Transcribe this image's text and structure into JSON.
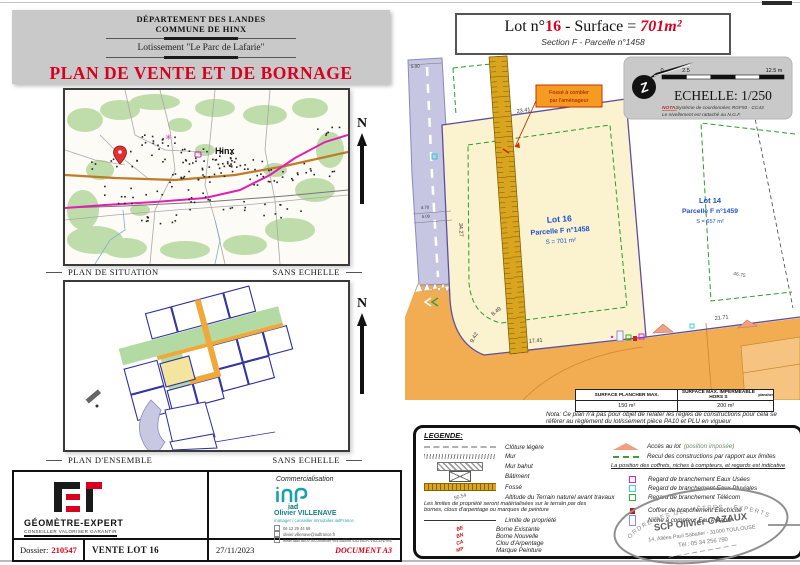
{
  "header": {
    "department": "DÉPARTEMENT DES LANDES",
    "commune": "COMMUNE DE HINX",
    "lotissement": "Lotissement \"Le Parc de Lafarie\"",
    "title": "PLAN DE VENTE ET DE BORNAGE"
  },
  "situation": {
    "town": "Hinx",
    "caption": "PLAN DE SITUATION",
    "scale_note": "SANS ECHELLE",
    "north": "N"
  },
  "ensemble": {
    "caption": "PLAN D'ENSEMBLE",
    "scale_note": "SANS ECHELLE",
    "north": "N"
  },
  "plan": {
    "title_prefix": "Lot n°",
    "lot_number": "16",
    "title_mid": " - Surface = ",
    "surface": "701m²",
    "subtitle": "Section F - Parcelle n°1458",
    "scalebox": {
      "scale": "ECHELLE: 1/250",
      "tick0": "0",
      "tick1": "2.5",
      "tick2": "12.5 m",
      "nota_label": "NOTA:",
      "nota1": "Système de coordonnées RGF93 - CC43",
      "nota2": "Le nivellement est rattaché au N.G.F."
    },
    "lot16": {
      "name": "Lot 16",
      "parcel": "Parcelle F n°1458",
      "area": "S = 701 m²"
    },
    "lot14": {
      "name": "Lot 14",
      "parcel": "Parcelle F n°1459",
      "area": "S = 657 m²"
    },
    "annotation_line1": "Fossé à combler",
    "annotation_line2": "par l'aménageur",
    "dims": {
      "top": "23.41",
      "road_length": "34.27",
      "road_width_top": "5.00",
      "w1": "4.78",
      "w2": "5.00",
      "curve1": "8.49",
      "curve2": "9.42",
      "front16": "17.41",
      "front14": "21.71",
      "side14": "46.75"
    },
    "nota": "Nota: Ce plan n'a pas pour objet de relater les règles de constructions pour cela se référer au règlement du lotissement pièce PA10 et PLU en vigueur"
  },
  "table": {
    "col1": "SURFACE PLANCHER MAX.",
    "col2": "SURFACE MAX. IMPERMEABLE HORS S",
    "col2_sub": "plancher",
    "val1": "150 m²",
    "val2": "200 m²"
  },
  "legend": {
    "title": "LEGENDE:",
    "items_left": [
      {
        "label": "Clôture légère"
      },
      {
        "label": "Mur"
      },
      {
        "label": "Mur bahut"
      },
      {
        "label": "Bâtiment"
      },
      {
        "label": "Fossé"
      }
    ],
    "altitude_value": "50.54",
    "altitude_label": "Altitude du Terrain naturel avant travaux",
    "limits_note": "Les limites de propriété seront matérialisées sur le terrain par des bornes, clous d'arpentage ou marques de peinture",
    "limite_label": "Limite de propriété",
    "bornes": [
      {
        "abbr": "BE",
        "label": "Borne Existante"
      },
      {
        "abbr": "BN",
        "label": "Borne Nouvelle"
      },
      {
        "abbr": "CA",
        "label": "Clou d'Arpentage"
      },
      {
        "abbr": "MP",
        "label": "Marque Peinture"
      }
    ],
    "acces_label": "Accès au lot",
    "acces_sub": "(position imposée)",
    "recul_label": "Recul des constructions par rapport aux limites",
    "position_note": "La position des coffrets, niches à compteurs, et regards est indicative",
    "regards": [
      {
        "label": "Regard de branchement Eaux Usées",
        "color": "#e020e0"
      },
      {
        "label": "Regard de branchement Eaux Pluviales",
        "color": "#35d5e5"
      },
      {
        "label": "Regard de branchement Télécom",
        "color": "#35b535"
      },
      {
        "label": "Coffret de branchement Électricité",
        "color": "#cc1111"
      },
      {
        "label": "Niche à compteur Eau Potable",
        "color": "#9090d8"
      }
    ]
  },
  "stamp": {
    "order": "ORDRE DES GÉOMÈTRES - EXPERTS",
    "name": "SCP Olivier CAZAUX",
    "address": "14, Allées Paul Sabatier - 31000 TOULOUSE",
    "phone": "Tél : 05 34 256 790"
  },
  "footer": {
    "brand": "GÉOMÈTRE-EXPERT",
    "tagline": "CONSEILLER VALORISER GARANTIR",
    "commercial_label": "Commercialisation",
    "iad": "iad",
    "agent_name": "Olivier VILLENAVE",
    "agent_role": "manager / conseiller immobilier iadFrance",
    "agent_phone": "06 12 29 44 69",
    "agent_email": "olivier.villenave@iadfrance.fr",
    "agent_web": "www.iadfrance.fr/conseiller-immobilier/OLIVIER.VILLENAVE",
    "dossier_label": "Dossier:",
    "dossier_number": "210547",
    "vente": "VENTE LOT 16",
    "date": "27/11/2023",
    "doc": "DOCUMENT A3"
  },
  "colors": {
    "accent_red": "#d8001e",
    "parcel_fill": "#fbf2cf",
    "road_orange": "#f2ad53",
    "road_lavender": "#c7c6e2",
    "fosse_gold": "#d9a41e",
    "setback_green": "#2f9a2f",
    "boundary_purple": "#5b4ea0",
    "lot_label_blue": "#1d4fd0"
  }
}
